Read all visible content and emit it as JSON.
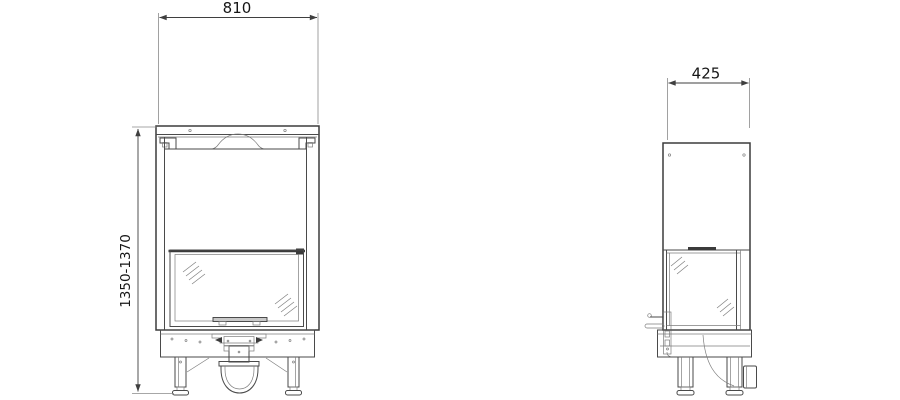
{
  "drawing": {
    "type": "technical-dimension-drawing",
    "background": "#ffffff",
    "line_color": "#3b3b3b",
    "views": {
      "front": {
        "width_dim": "810",
        "height_dim": "1350-1370"
      },
      "side": {
        "depth_dim": "425"
      }
    }
  }
}
